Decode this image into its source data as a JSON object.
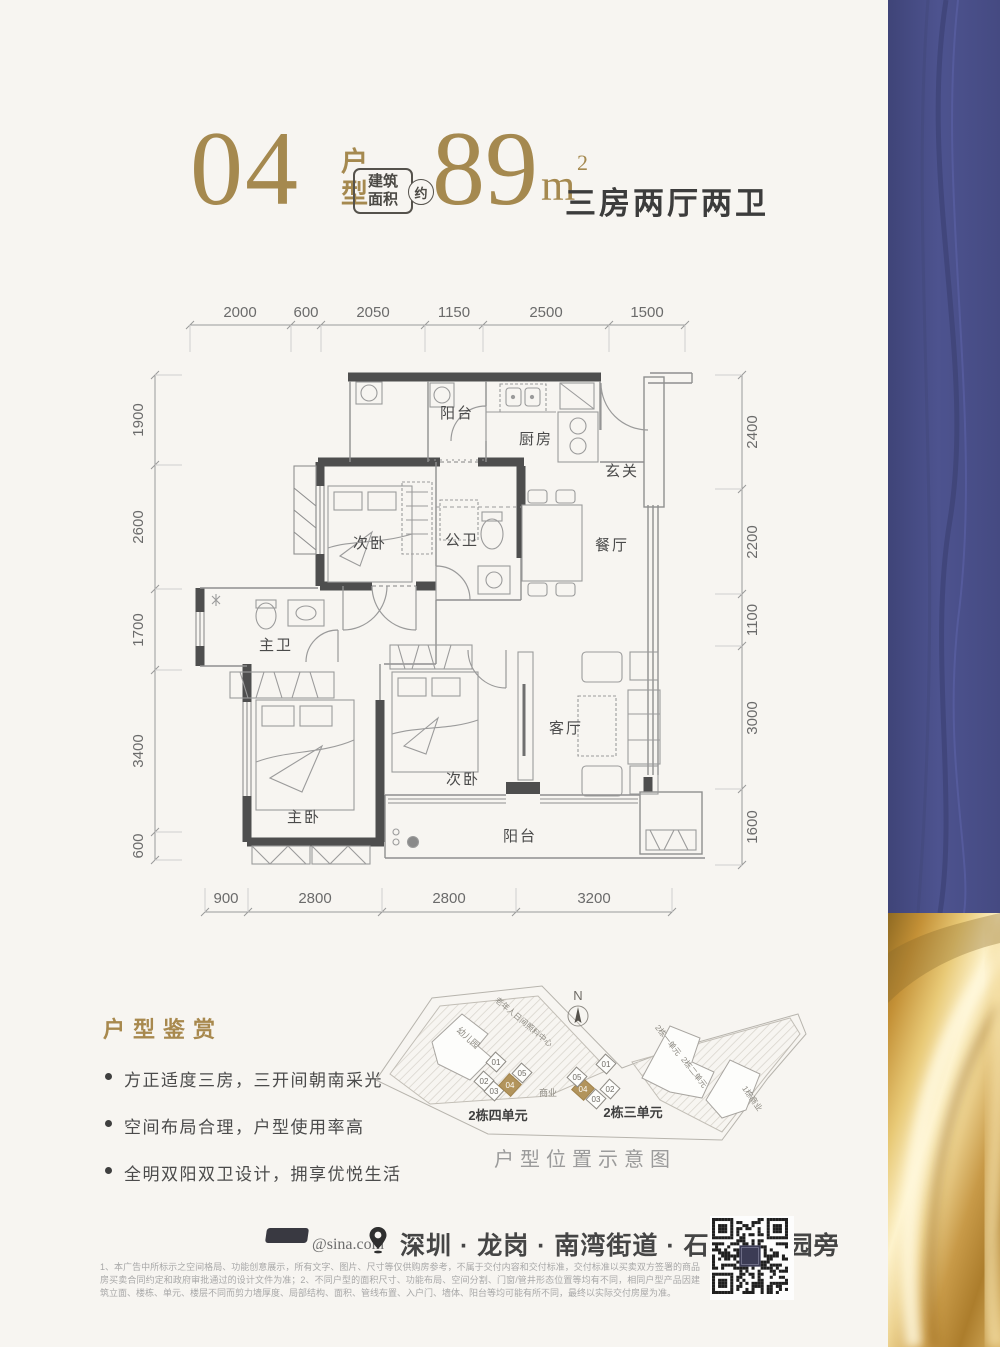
{
  "header": {
    "unit_number": "04",
    "unit_type_label": "户型",
    "area_box": {
      "line1": "建筑",
      "line2": "面积",
      "approx": "约"
    },
    "area_value": "89",
    "area_unit": "m",
    "area_exponent": "2",
    "layout_summary": "三房两厅两卫"
  },
  "plan": {
    "dims_top": [
      "2000",
      "600",
      "2050",
      "1150",
      "2500",
      "1500"
    ],
    "dims_left": [
      "1900",
      "2600",
      "1700",
      "3400",
      "600"
    ],
    "dims_right": [
      "2400",
      "2200",
      "1100",
      "3000",
      "1600"
    ],
    "dims_bottom": [
      "900",
      "2800",
      "2800",
      "3200"
    ],
    "rooms": {
      "balcony_top": "阳台",
      "kitchen": "厨房",
      "foyer": "玄关",
      "bedroom2": "次卧",
      "bath_shared": "公卫",
      "dining": "餐厅",
      "bath_master": "主卫",
      "bedroom_master": "主卧",
      "bedroom3": "次卧",
      "living": "客厅",
      "balcony_bottom": "阳台"
    }
  },
  "features": {
    "title": "户型鉴赏",
    "items": [
      "方正适度三房，三开间朝南采光",
      "空间布局合理，户型使用率高",
      "全明双阳双卫设计，拥享优悦生活"
    ]
  },
  "siteplan": {
    "north_label": "N",
    "caption": "户型位置示意图",
    "area_labels": {
      "kindergarten": "幼儿园",
      "eldercare": "老年人日间照料中心",
      "commerce": "商业",
      "block1_commerce": "1栋商业",
      "b2_unit1": "2栋一单元",
      "b2_unit2": "2栋二单元"
    },
    "cluster_left_title": "2栋四单元",
    "cluster_right_title": "2栋三单元",
    "cluster_left_units": [
      "01",
      "02",
      "03",
      "04",
      "05"
    ],
    "cluster_right_units": [
      "01",
      "02",
      "03",
      "04",
      "05"
    ]
  },
  "footer": {
    "social_handle": "@sina.com",
    "address": "深圳 · 龙岗 · 南湾街道 · 石芽岭公园旁",
    "disclaimer": "1、本广告中所标示之空间格局、功能创意展示，所有文字、图片、尺寸等仅供购房参考，不属于交付内容和交付标准，交付标准以买卖双方签署的商品房买卖合同约定和政府审批通过的设计文件为准；2、不同户型的面积尺寸、功能布局、空间分割、门窗/管井形态位置等均有不同，相同户型产品因建筑立面、楼栋、单元、楼层不同而剪力墙厚度、局部结构、面积、管线布置、入户门、墙体、阳台等均可能有所不同，最终以实际交付房屋为准。"
  },
  "colors": {
    "gold": "#a5894f",
    "blue_band": "#4a4f8a",
    "wall": "#4e4e4e",
    "unit_highlight": "#b2945c"
  }
}
